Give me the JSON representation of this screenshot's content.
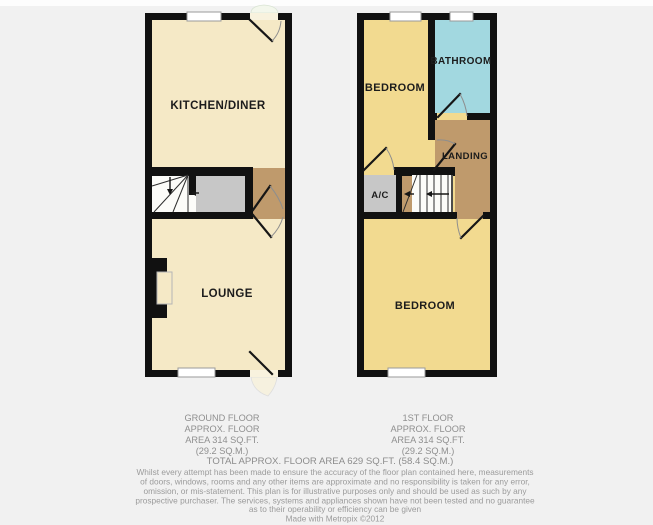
{
  "colors": {
    "background": "#f1f1f1",
    "wall": "#111111",
    "cream": "#f5e9c6",
    "yellow": "#f2da90",
    "blue": "#a2d8e0",
    "brown": "#bf9a6c",
    "gray": "#c7c7c7",
    "stairs_white": "#fcfcf9",
    "door_gap": "#f8f2de",
    "ext_door_fill": "#f4f7ec"
  },
  "ground_floor": {
    "labels": {
      "kitchen": "KITCHEN/DINER",
      "lounge": "LOUNGE"
    },
    "caption": [
      "GROUND FLOOR",
      "APPROX. FLOOR",
      "AREA 314 SQ.FT.",
      "(29.2 SQ.M.)"
    ]
  },
  "first_floor": {
    "labels": {
      "bedroom_front": "BEDROOM",
      "bathroom": "BATHROOM",
      "landing": "LANDING",
      "ac": "A/C",
      "bedroom_back": "BEDROOM"
    },
    "caption": [
      "1ST FLOOR",
      "APPROX. FLOOR",
      "AREA 314 SQ.FT.",
      "(29.2 SQ.M.)"
    ]
  },
  "summary": {
    "total": "TOTAL APPROX. FLOOR AREA 629 SQ.FT. (58.4 SQ.M.)"
  },
  "disclaimer": {
    "lines": [
      "Whilst every attempt has been made to ensure the accuracy of the floor plan contained here, measurements",
      "of doors, windows, rooms and any other items are approximate and no responsibility is taken for any error,",
      "omission, or mis-statement. This plan is for illustrative purposes only and should be used as such by any",
      "prospective purchaser. The services, systems and appliances shown have not been tested and no guarantee",
      "as to their operability or efficiency can be given"
    ],
    "credit": "Made with Metropix ©2012"
  }
}
